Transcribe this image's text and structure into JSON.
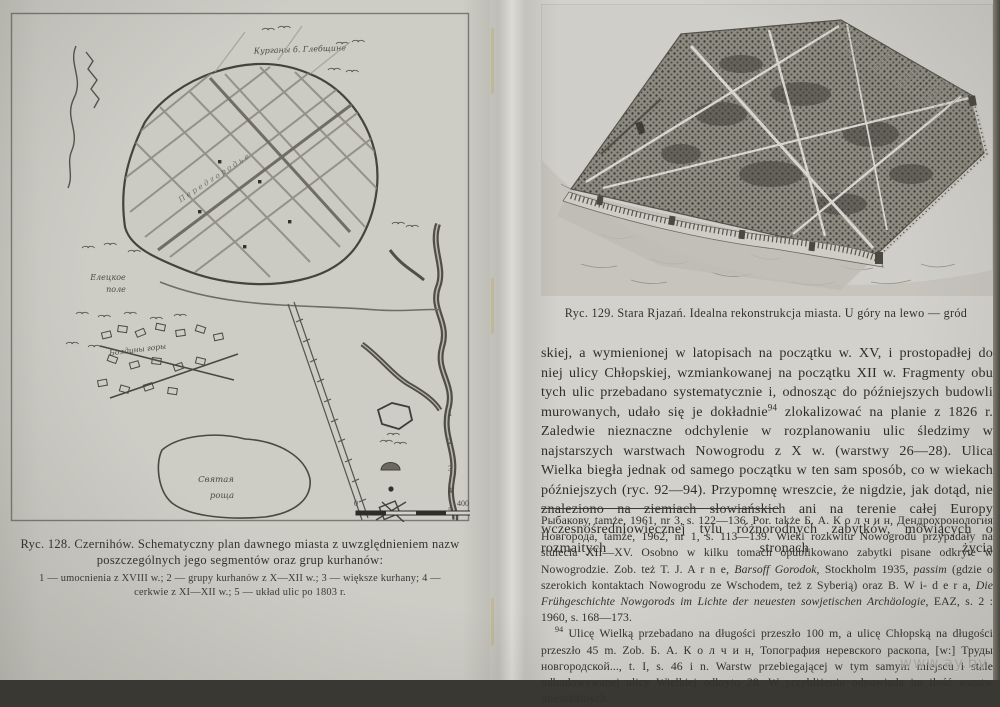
{
  "left_page": {
    "map": {
      "labels": {
        "kurgany_top": "Курганы б. Глебщине",
        "peredgorod": "П е р е д г о р о д ь е",
        "pole_l1": "Елецкое",
        "pole_l2": "поле",
        "boldiny": "Болдины горы",
        "roshcha_l1": "Святая",
        "roshcha_l2": "роща"
      },
      "legend_items": [
        "1",
        "2",
        "3",
        "4",
        "5"
      ],
      "scale": {
        "zero": "0",
        "end": "400 м"
      }
    },
    "caption": {
      "line1": "Ryc. 128. Czernihów. Schematyczny plan dawnego miasta z uwzględnieniem nazw",
      "line2": "poszczególnych jego segmentów oraz grup kurhanów:",
      "legend_line1": "1 — umocnienia z XVIII w.; 2 — grupy kurhanów z X—XII w.; 3 — większe kurhany; 4 —",
      "legend_line2": "cerkwie z XI—XII w.; 5 — układ ulic po 1803 r."
    }
  },
  "right_page": {
    "figure_caption": "Ryc. 129. Stara Rjazań. Idealna rekonstrukcja miasta. U góry na lewo — gród",
    "body": {
      "p1a": "skiej, a wymienionej w latopisach na początku w. XV, i prostopadłej do niej ulicy Chłopskiej, wzmiankowanej na początku XII w. Fragmenty obu tych ulic przebadano systematycznie i, odnosząc do późniejszych budowli murowanych, udało się je dokładnie",
      "fn_marker": "94",
      "p1b": " zlokalizować na planie z 1826 r. Zaledwie nieznaczne odchylenie w rozplanowaniu ulic śledzimy w najstarszych warstwach Nowogrodu z X w. (warstwy 26—28). Ulica Wielka biegła jednak od samego początku w ten sam sposób, co w wiekach późniejszych (ryc. 92—94). Przypomnę wreszcie, że nigdzie, jak dotąd, nie znaleziono na ziemiach słowiańskich ani na terenie całej Europy wczesnośredniowiecznej tylu różnorodnych zabytków, mówiących o rozmaitych stronach życia"
    },
    "footnotes": {
      "f93_r1": "Рыбакову, tamże, 1961, nr 3, s. 122—136. Por. także Б. А. К о л ч и н, Дендрохронология Новгорода, tamże, 1962, nr 1, s. 113—139. Wieki rozkwitu Nowogrodu przypadały na stulecia XII—XV. Osobno w kilku tomach opublikowano zabytki pisane odkryte w Nowogrodzie. Zob. też T. J. A r n e, ",
      "f93_i1": "Barsoff Gorodok,",
      "f93_r2": " Stockholm 1935, ",
      "f93_i2": "passim",
      "f93_r3": " (gdzie o szerokich kontaktach Nowogrodu ze Wschodem, też z Syberią) oraz B. W i- d e r a, ",
      "f93_i3": "Die Frühgeschichte Nowgorods im Lichte der neuesten sowjetischen Archäologie,",
      "f93_r4": " EAZ, s. 2 : 1960, s. 168—173.",
      "f94_marker": "94",
      "f94_r1": " Ulicę Wielką przebadano na długości przeszło 100 m, a ulicę Chłopską na długości przeszło 45 m. Zob. Б. А. К о л ч и н, Топография неревского раскопа, [w:] Труды новгородской..., t. I, s. 46 i n. Warstw przebiegającej w tym samym miejscu i stale odbudowywanej ulicy Wielkiej odkryto 28. W przybliżeniu odpowiada im ilość warstw mieszkalnych."
    },
    "watermark": "www.ay.by"
  }
}
